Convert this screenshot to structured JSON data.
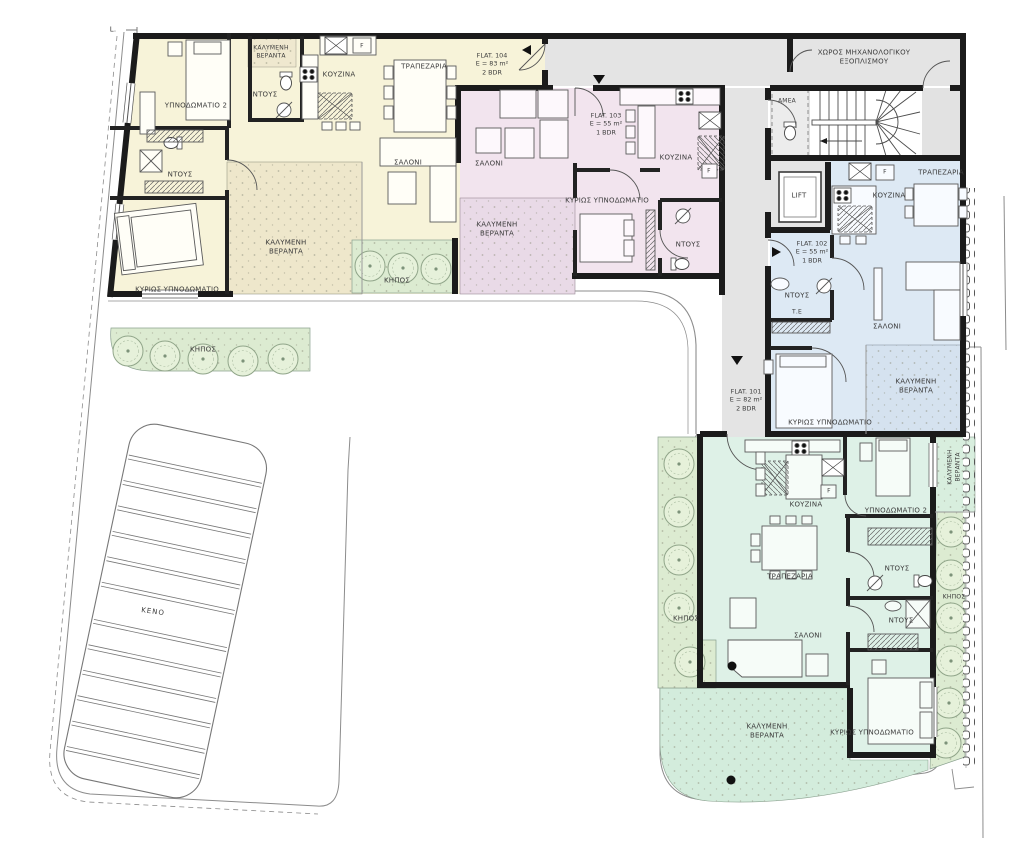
{
  "plan_title": "First floor plan - 4 flats",
  "datum_mark": "L.",
  "common": {
    "mechanical_room": "ΧΩΡΟΣ ΜΗΧΑΝΟΛΟΓΙΚΟΥ ΕΞΟΠΛΙΣΜΟΥ",
    "accessible_wc": "ΑΜΕΑ",
    "lift": "LIFT",
    "void": "ΚΕΝΟ",
    "garden": "ΚΗΠΟΣ",
    "laundry": "Τ.Ε"
  },
  "room_names": {
    "kitchen": "ΚΟΥΖΙΝΑ",
    "dining": "ΤΡΑΠΕΖΑΡΙΑ",
    "salon": "ΣΑΛΟΝΙ",
    "bedroom2": "ΥΠΝΟΔΩΜΑΤΙΟ 2",
    "master": "ΚΥΡΙΩΣ ΥΠΝΟΔΩΜΑΤΙΟ",
    "shower": "ΝΤΟΥΣ",
    "covered_veranda": "ΚΑΛΥΜΕΝΗ ΒΕΡΑΝΤΑ",
    "fridge": "F"
  },
  "flats": {
    "f104": {
      "title": "FLAT. 104",
      "area": "E = 83 m²",
      "bdr": "2 BDR",
      "color": "#f7f3d9"
    },
    "f103": {
      "title": "FLAT. 103",
      "area": "E = 55 m²",
      "bdr": "1 BDR",
      "color": "#f2e4ee"
    },
    "f102": {
      "title": "FLAT. 102",
      "area": "E = 55 m²",
      "bdr": "1 BDR",
      "color": "#dde9f4"
    },
    "f101": {
      "title": "FLAT. 101",
      "area": "E = 82 m²",
      "bdr": "2 BDR",
      "color": "#def1e7"
    }
  },
  "colors": {
    "wall": "#1b1b1b",
    "hall_gray": "#e4e4e4",
    "garden_green": "#dcebd1",
    "furniture_line": "#5a5a5a"
  }
}
